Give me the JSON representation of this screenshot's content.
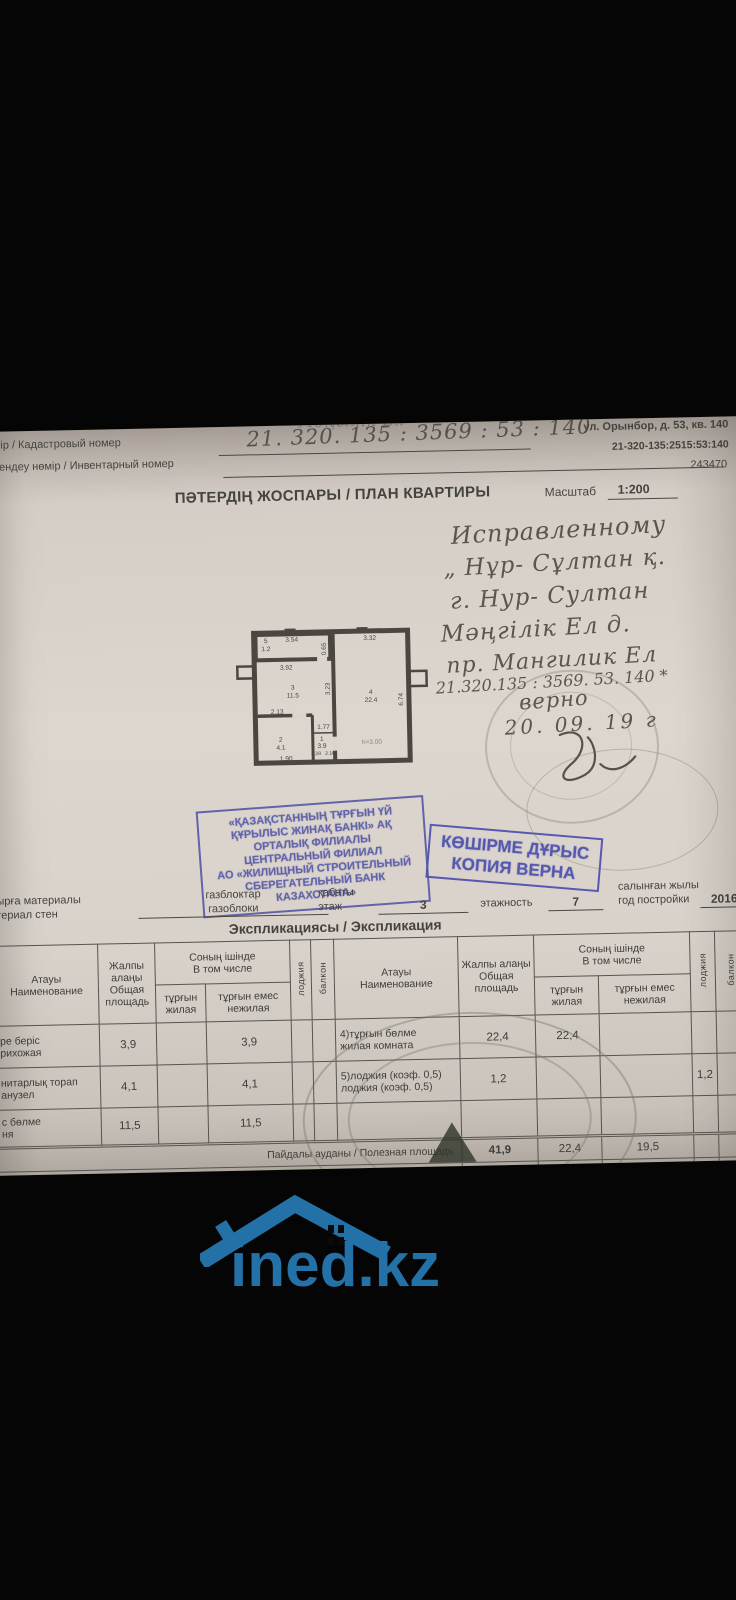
{
  "colors": {
    "accent_blue": "#2471a8",
    "stamp_blue": "#4f53ae",
    "paper": "#d8d2ca"
  },
  "header": {
    "cadastral_label": "нөмір / Кадастровый номер",
    "inventory_label": "Түгендеу нөмір / Инвентарный номер",
    "cadastral_number_handwritten": "21. 320. 135 : 3569 : 53 : 140",
    "scribble": "Мәңгілік Ел",
    "address": "ул. Орынбор, д. 53, кв. 140",
    "cadastral_number_printed": "21-320-135:2515:53:140",
    "code": "243470"
  },
  "title": {
    "text": "ПӘТЕРДІҢ ЖОСПАРЫ / ПЛАН КВАРТИРЫ",
    "scale_label": "Масштаб",
    "scale_value": "1:200"
  },
  "handwriting": {
    "lines": [
      {
        "text": "Исправленному"
      },
      {
        "text": "„ Нұр- Сұлтан қ."
      },
      {
        "text": "г. Нур- Султан"
      },
      {
        "text": "Мәңгілік Ел д."
      },
      {
        "text": "пр. Мангилик Ел"
      },
      {
        "text": "21.320.135 : 3569. 53. 140 *"
      },
      {
        "text": "верно"
      },
      {
        "text": "20. 09. 19 г"
      }
    ]
  },
  "plan": {
    "labels": [
      {
        "text": "5"
      },
      {
        "text": "1.2"
      },
      {
        "text": "3.54"
      },
      {
        "text": "0.65"
      },
      {
        "text": "3.92"
      },
      {
        "text": "3"
      },
      {
        "text": "11.5"
      },
      {
        "text": "3.23"
      },
      {
        "text": "2.13"
      },
      {
        "text": "2"
      },
      {
        "text": "4.1"
      },
      {
        "text": "1.90"
      },
      {
        "text": "1.77"
      },
      {
        "text": "1"
      },
      {
        "text": "3.9"
      },
      {
        "text": "2.28"
      },
      {
        "text": "2.10"
      },
      {
        "text": "3.32"
      },
      {
        "text": "4"
      },
      {
        "text": "22.4"
      },
      {
        "text": "6.74"
      },
      {
        "text": "h=3.00"
      }
    ]
  },
  "stamps": {
    "bank": {
      "lines": [
        {
          "text": "«ҚАЗАҚСТАННЫҢ ТҰРҒЫН ҮЙ"
        },
        {
          "text": "ҚҰРЫЛЫС ЖИНАҚ БАНКІ» АҚ"
        },
        {
          "text": "ОРТАЛЫҚ ФИЛИАЛЫ"
        },
        {
          "text": "ЦЕНТРАЛЬНЫЙ ФИЛИАЛ"
        },
        {
          "text": "АО «ЖИЛИЩНЫЙ СТРОИТЕЛЬНЫЙ"
        },
        {
          "text": "СБЕРЕГАТЕЛЬНЫЙ БАНК КАЗАХСТАНА»"
        }
      ]
    },
    "copy": {
      "line1": "КӨШІРМЕ ДҰРЫС",
      "line2": "КОПИЯ ВЕРНА"
    }
  },
  "materials": {
    "wall_label_kz": "бырға материалы",
    "wall_label_ru": "атериал стен",
    "wall_value_kz": "газблоктар",
    "wall_value_ru": "газоблоки",
    "floor_label_kz": "қабаты",
    "floor_label_ru": "этаж",
    "floor_value": "3",
    "floors_label_ru": "этажность",
    "floors_value": "7",
    "year_label_kz": "салынған жылы",
    "year_label_ru": "год постройки",
    "year_value": "2016"
  },
  "expl": {
    "title": "Экспликациясы / Экспликация",
    "headers": {
      "name_kz": "Атауы",
      "name_ru": "Наименование",
      "total_kz": "Жалпы алаңы",
      "total_ru": "Общая площадь",
      "incl_kz": "Соның ішінде",
      "incl_ru": "В том числе",
      "living_kz": "тұрғын",
      "living_ru": "жилая",
      "nonliving_kz": "тұрғын емес",
      "nonliving_ru": "нежилая",
      "loggia": "лоджия",
      "balcony": "балкон"
    },
    "rows": [
      {
        "l_kz": "ре беріс",
        "l_ru": "рихожая",
        "l_total": "3,9",
        "l_nonliving": "3,9",
        "r_kz": "4)тұрғын бөлме",
        "r_ru": "жилая комната",
        "r_total": "22,4",
        "r_living": "22,4"
      },
      {
        "l_kz": "нитарлық торап",
        "l_ru": "анузел",
        "l_total": "4,1",
        "l_nonliving": "4,1",
        "r_kz": "5)лоджия (коэф. 0,5)",
        "r_ru": "лоджия (коэф. 0,5)",
        "r_total": "1,2",
        "r_loggia": "1,2"
      },
      {
        "l_kz": "с бөлме",
        "l_ru": "ня",
        "l_total": "11,5",
        "l_nonliving": "11,5",
        "r_kz": "",
        "r_ru": "",
        "r_total": ""
      }
    ],
    "footer": [
      {
        "label": "Пайдалы ауданы / Полезная площадь",
        "total": "41,9",
        "living": "22,4",
        "nonliving": "19,5",
        "loggia": ""
      },
      {
        "label": "Қорытынды / Итого",
        "total": "43,1",
        "living": "22,4",
        "nonliving": "19,5",
        "loggia": "1,2"
      }
    ]
  },
  "watermark": {
    "logo_text": "ined.kz"
  }
}
